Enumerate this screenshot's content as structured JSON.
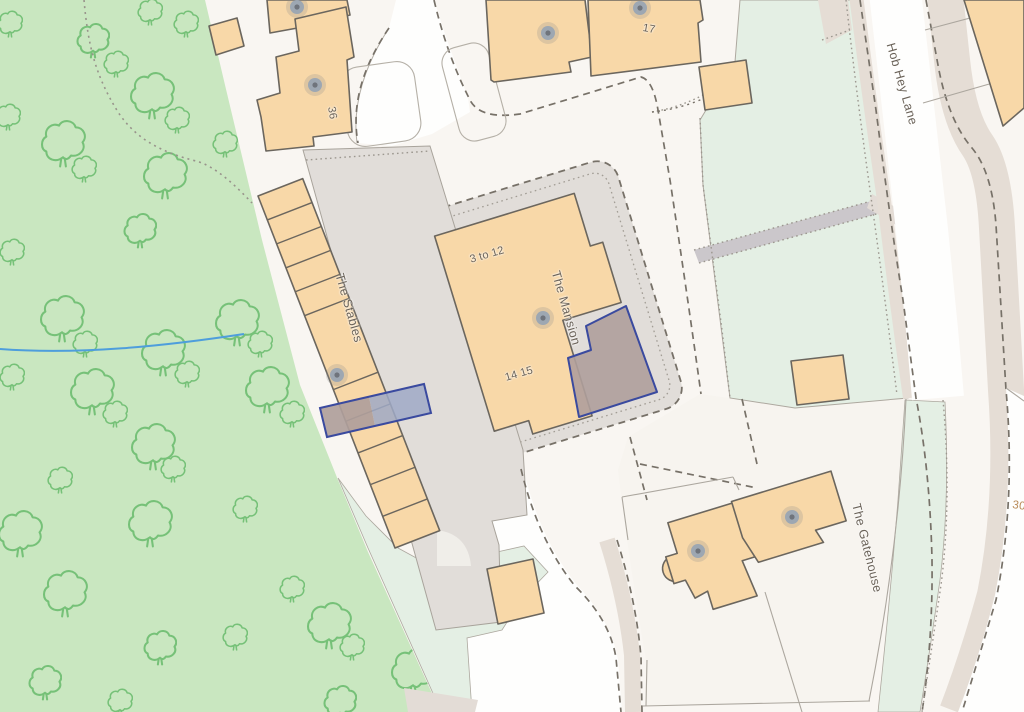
{
  "map": {
    "title": "OS-style site plan with selected plots",
    "labels": {
      "hob_hey_lane": "Hob Hey Lane",
      "the_stables": "The Stables",
      "the_mansion": "The Mansion",
      "the_gatehouse": "The Gatehouse",
      "flats_3_to_12": "3 to 12",
      "flats_14_15": "14 15",
      "no_17": "17",
      "no_36": "36",
      "no_30": "30"
    },
    "colors": {
      "woodland": "#C9E7C0",
      "tree_outline": "#76C178",
      "amenity_green": "#E4EFE4",
      "building_fill": "#F8D8A8",
      "building_outline": "#6B665E",
      "paving": "#E1DDD9",
      "verge": "#E5DDD5",
      "footpath": "#CBC7CB",
      "stream": "#4E9EDC",
      "selection_outline": "#3A4A9F",
      "selection_fill_over_paving": "#9FA9C5",
      "selection_fill_over_building": "#AF9E9B",
      "label_text": "#6A6258",
      "house_number_text": "#B98A57",
      "boundary_dash": "#777168"
    }
  }
}
